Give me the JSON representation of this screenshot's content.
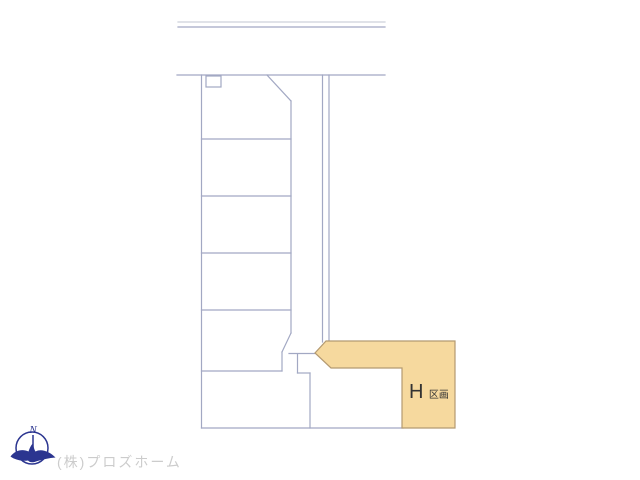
{
  "plan": {
    "parcel": {
      "main": "H",
      "suffix": "区画"
    },
    "compass": {
      "north_label": "N"
    },
    "footer": {
      "company": "(株)プロズホーム"
    }
  },
  "colors": {
    "line": "#a2a8c3",
    "line_light": "#cdd0da",
    "parcel_fill": "#f6d99e",
    "parcel_border": "#b49a71",
    "parcel_label": "#333333",
    "compass": "#2b3590",
    "company": "#cccccc"
  }
}
